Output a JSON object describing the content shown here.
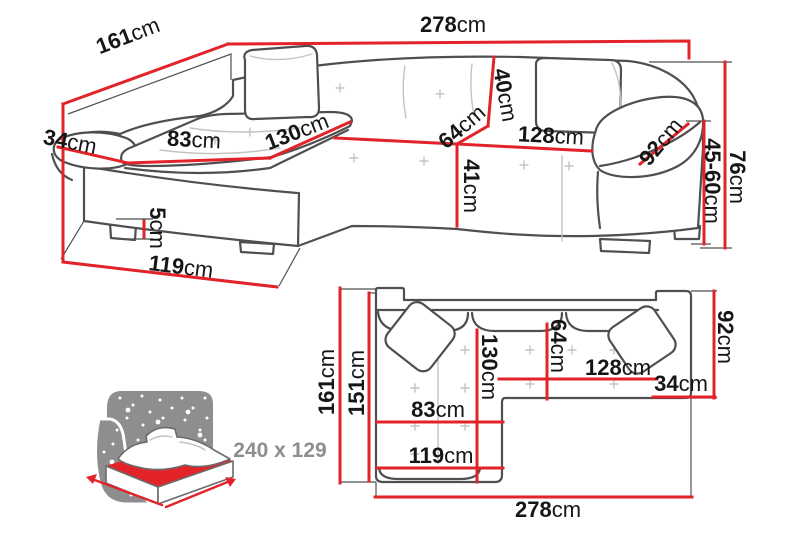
{
  "unit": "cm",
  "view_3d": {
    "total_width": "278",
    "side_depth": "161",
    "armrest_width": "34",
    "chaise_seat_width": "83",
    "chaise_length": "130",
    "backrest_height": "40",
    "seat_depth": "64",
    "seat_width": "128",
    "armrest_depth": "92",
    "base_height": "41",
    "total_height": "76",
    "seat_height": "45-60",
    "leg_height": "5",
    "chaise_depth": "119"
  },
  "view_plan": {
    "total_depth": "161",
    "inner_depth": "151",
    "chaise_length": "130",
    "seat_depth": "64",
    "seat_width": "128",
    "armrest_width": "34",
    "armrest_depth": "92",
    "chaise_seat_width": "83",
    "chaise_width": "119",
    "total_width": "278"
  },
  "sleeping_area": {
    "size_label": "240 x 129"
  },
  "colors": {
    "dimension_red": "#e2232a",
    "outline_gray": "#4f4f51",
    "detail_gray": "#c3c3c5",
    "icon_gray": "#8e8e90",
    "label_black": "#161616"
  }
}
